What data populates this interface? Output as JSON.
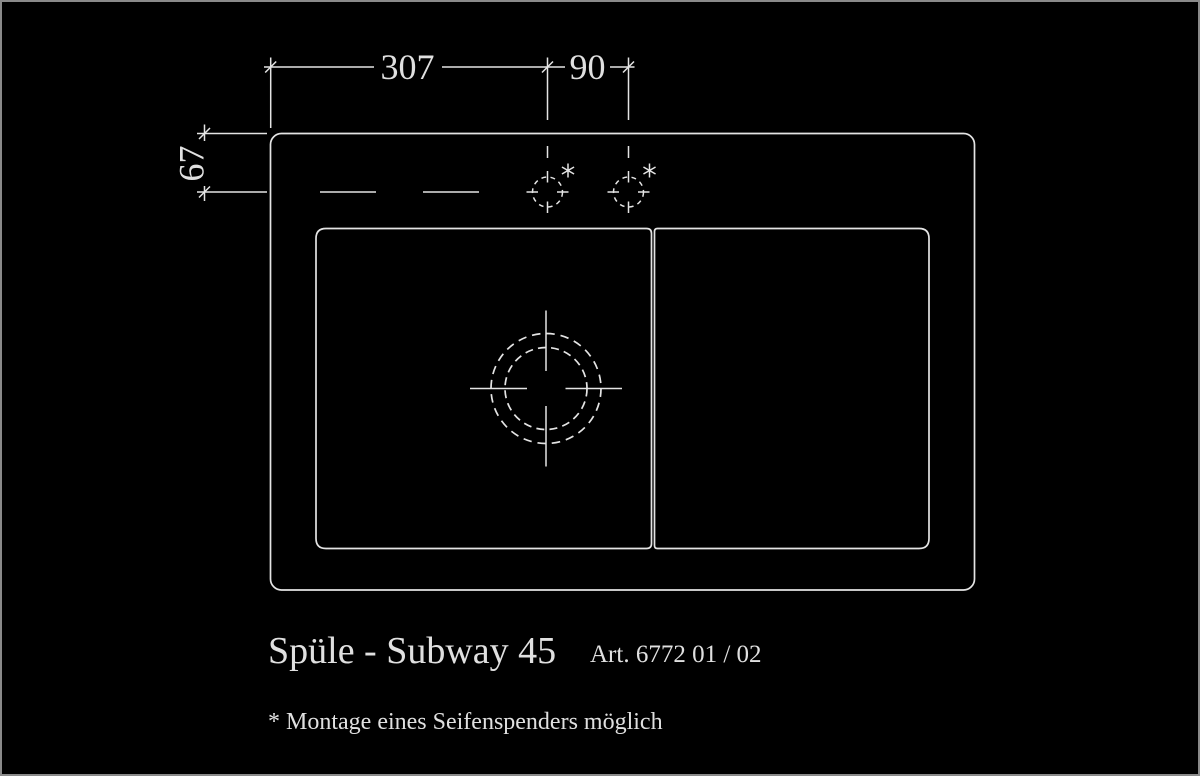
{
  "page": {
    "background_color": "#000000",
    "line_color": "#e4e4e4",
    "border_color": "#8a8a8a"
  },
  "drawing": {
    "product_title": "Spüle - Subway 45",
    "article_number": "Art. 6772 01 / 02",
    "footnote": "* Montage eines Seifenspenders möglich",
    "dimensions": {
      "top_width": "307",
      "tap_spacing": "90",
      "tap_depth": "67"
    },
    "icons": {
      "asterisk_mark": "asterisk",
      "tap_hole": "dashed-circle-center-mark",
      "drain": "concentric-dashed-circles-center-mark"
    }
  }
}
